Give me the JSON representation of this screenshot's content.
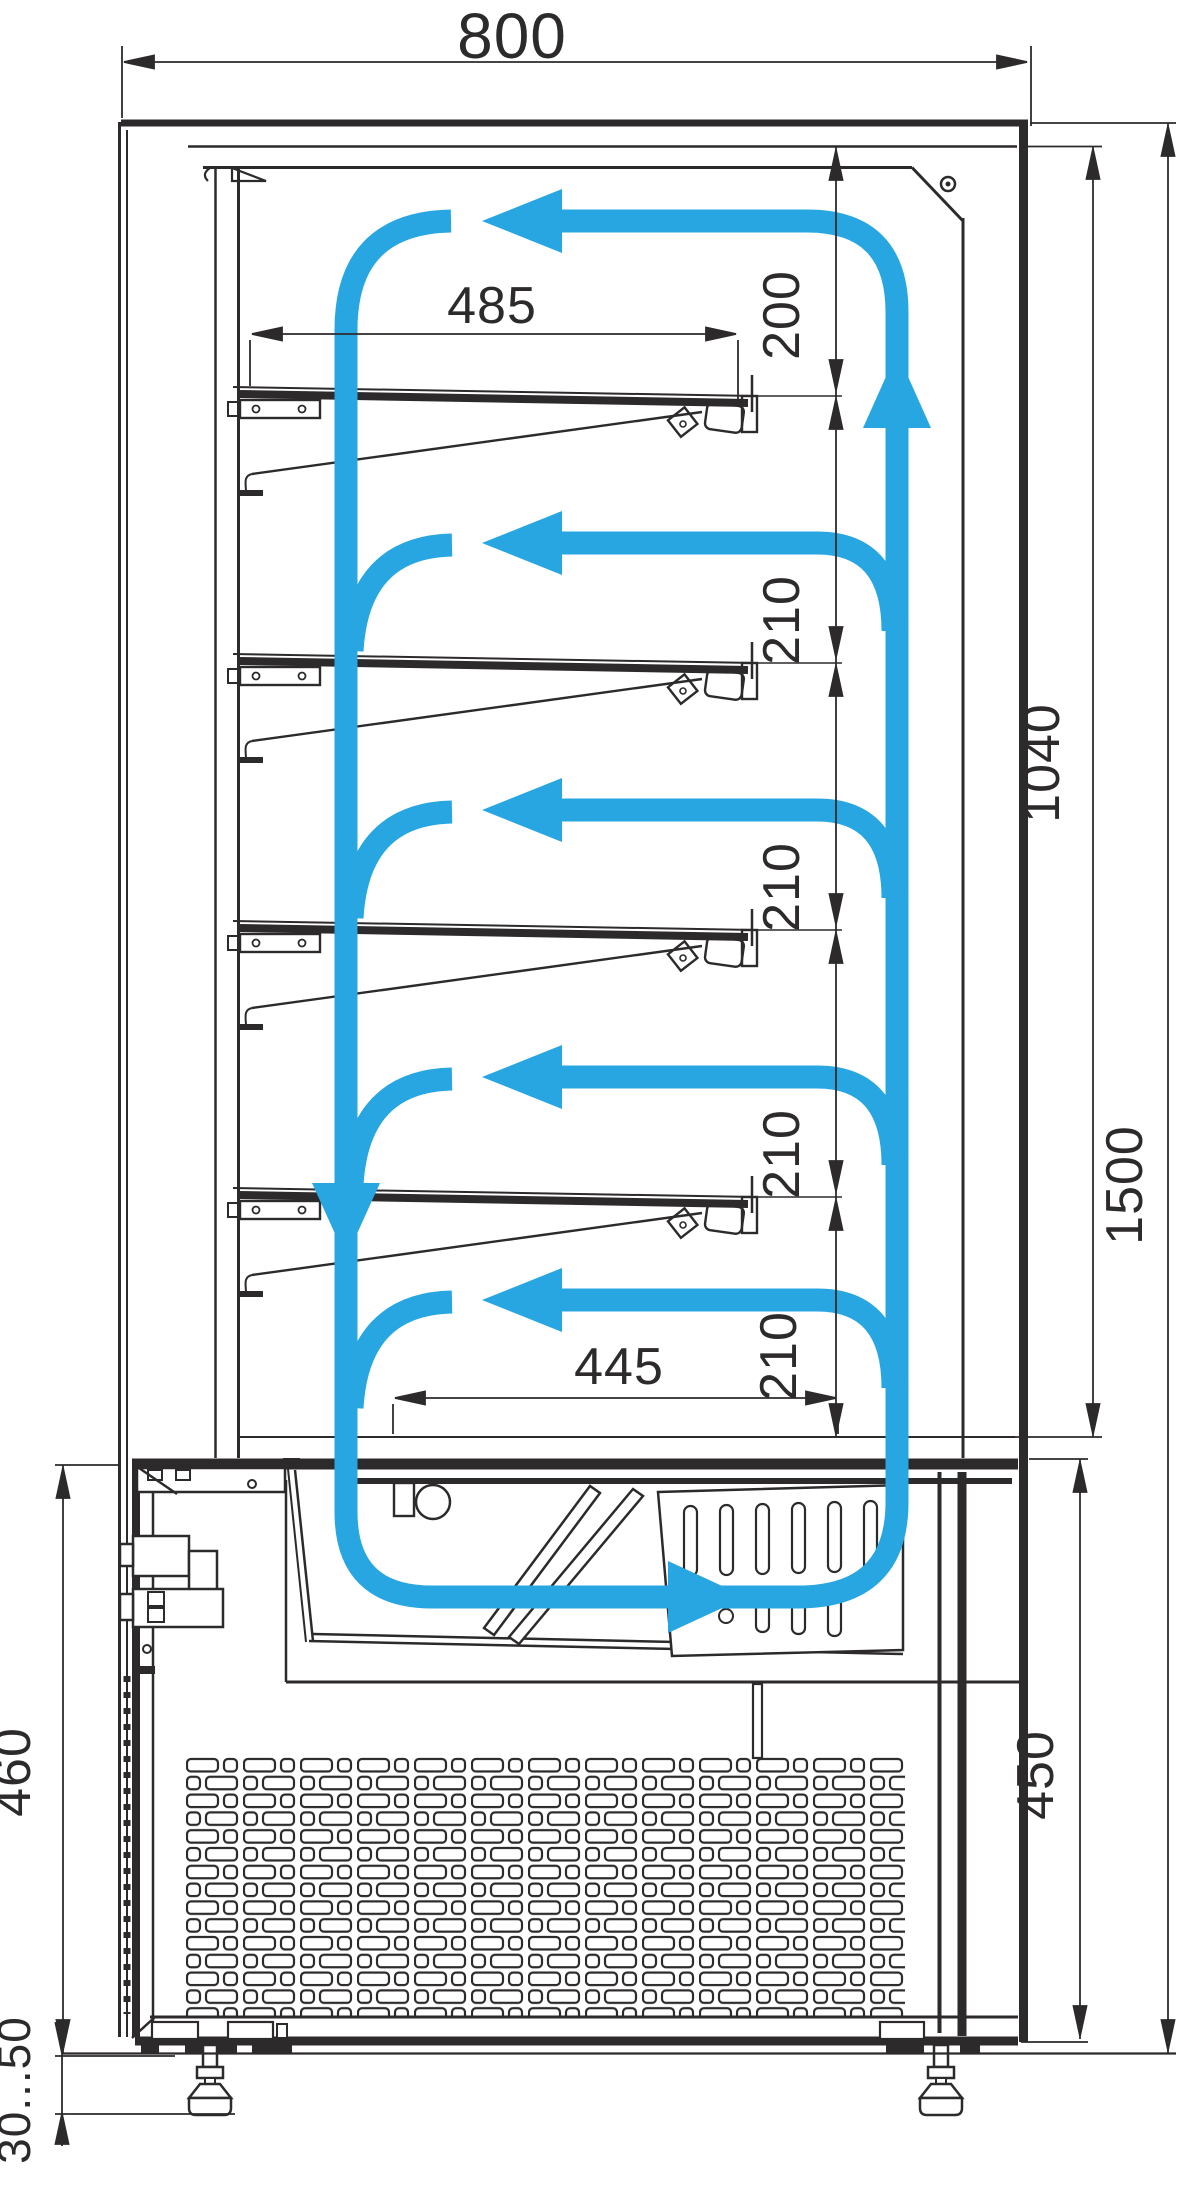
{
  "drawing": {
    "kind": "refrigerated-display-case-section",
    "colors": {
      "line": "#2d2a2b",
      "airflow": "#27a6e1",
      "background": "#ffffff"
    }
  },
  "labels": {
    "overall_width": "800",
    "shelf_clearance": "485",
    "top_gap": "200",
    "gap_1": "210",
    "gap_2": "210",
    "gap_3": "210",
    "gap_4": "210",
    "interior_height": "1040",
    "overall_height": "1500",
    "deck_clearance": "445",
    "base_height_left": "460",
    "base_height_right": "450",
    "foot_adjust_range": "30...50"
  }
}
